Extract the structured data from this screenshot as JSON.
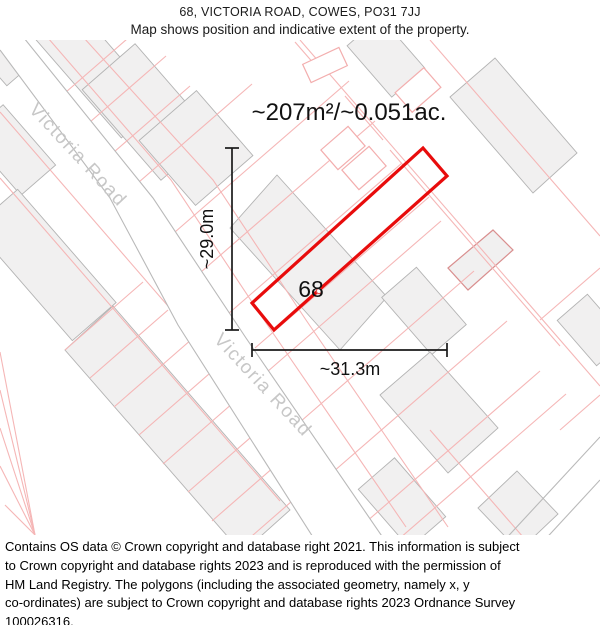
{
  "header": {
    "title": "68, VICTORIA ROAD, COWES, PO31 7JJ",
    "subtitle": "Map shows position and indicative extent of the property."
  },
  "map": {
    "area_label": "~207m²/~0.051ac.",
    "height_dimension": "~29.0m",
    "width_dimension": "~31.3m",
    "plot_number": "68",
    "road_name": "Victoria Road",
    "colors": {
      "property_outline": "#e80c0c",
      "parcel_line": "#f5b6b6",
      "building_fill": "#f1f0f0",
      "building_stroke": "#b3b3b3",
      "road_edge": "#b9b9b9",
      "road_label_text": "#c7c7c7",
      "dimension_line": "#1a1a1a"
    }
  },
  "footer": {
    "lines": [
      "Contains OS data © Crown copyright and database right 2021. This information is subject",
      "to Crown copyright and database rights 2023 and is reproduced with the permission of",
      "HM Land Registry. The polygons (including the associated geometry, namely x, y",
      "co-ordinates) are subject to Crown copyright and database rights 2023 Ordnance Survey",
      "100026316."
    ]
  }
}
